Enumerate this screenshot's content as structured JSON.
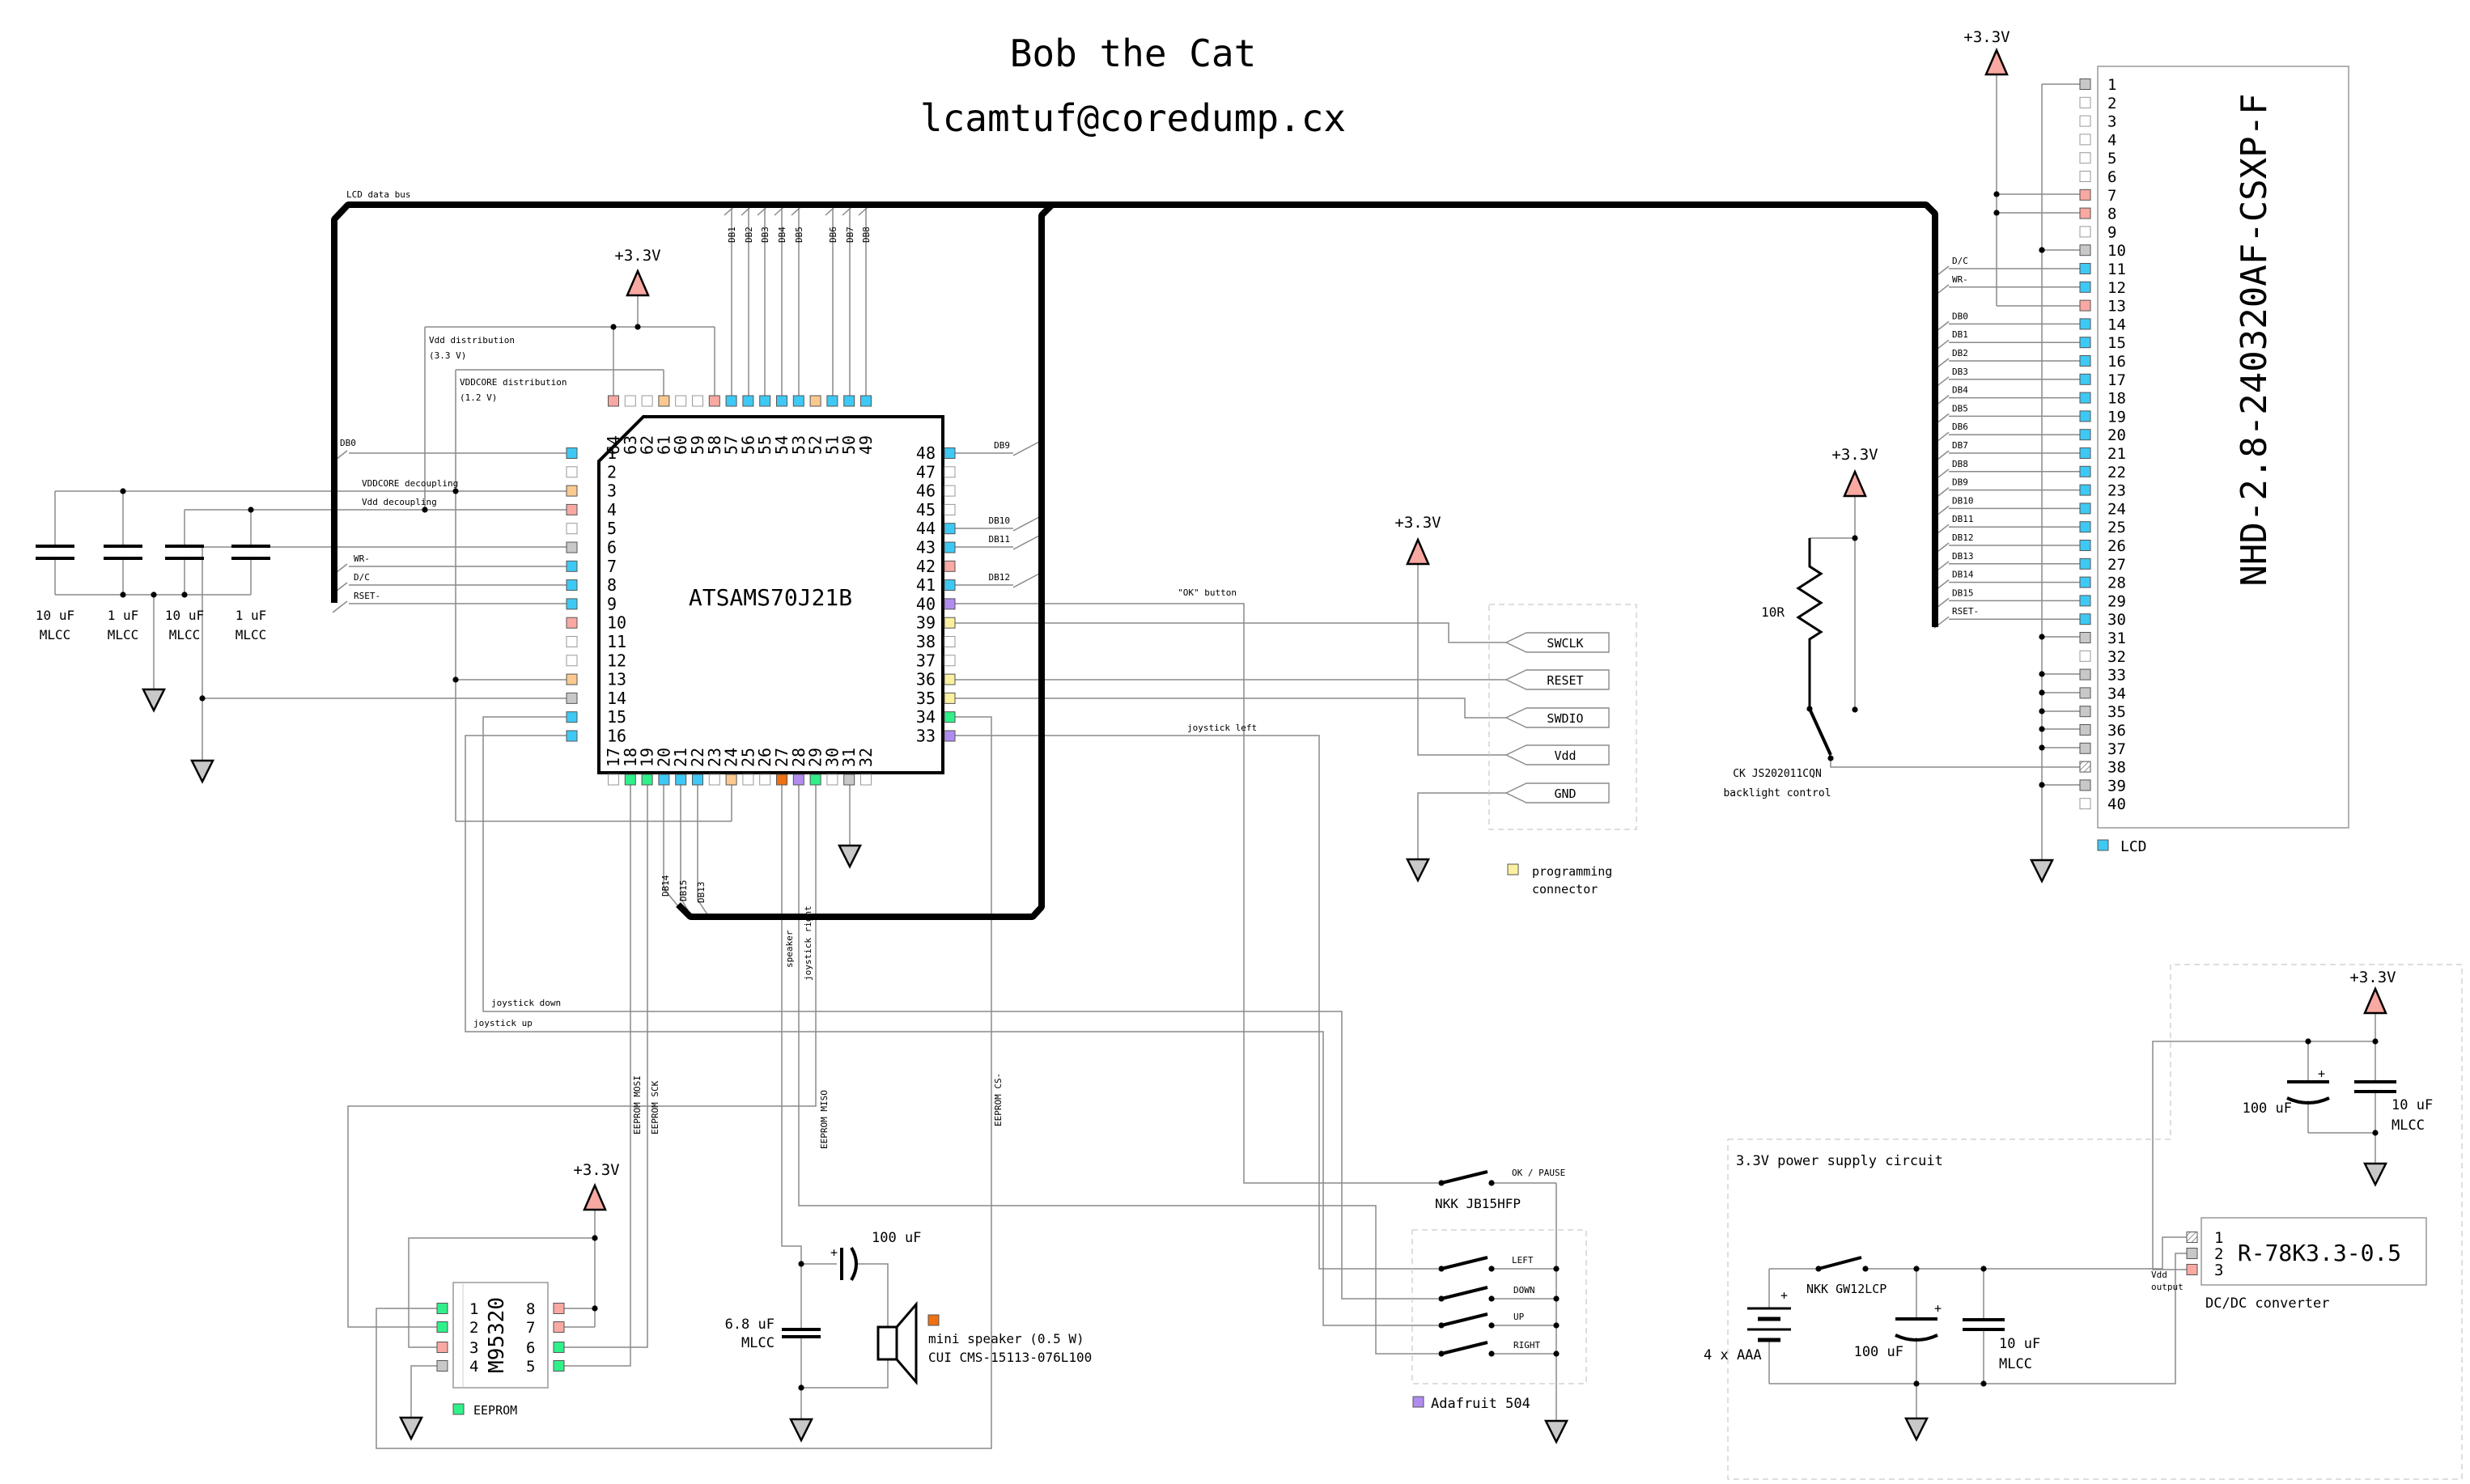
{
  "title": {
    "line1": "Bob the Cat",
    "line2": "lcamtuf@coredump.cx"
  },
  "colors": {
    "blue": "#3ec9f5",
    "pink": "#f9a8a2",
    "orange": "#fbc98f",
    "green": "#30f08a",
    "purple": "#b18cf0",
    "yellow": "#faf0a0",
    "gray": "#c8c8c8",
    "white": "#ffffff",
    "dark_orange": "#ef7012",
    "bus": "#000000",
    "wire": "#8a8a8a"
  },
  "bus_label": "LCD data bus",
  "rails": {
    "v33": "+3.3V"
  },
  "mcu": {
    "name": "ATSAMS70J21B",
    "left_pins": [
      {
        "n": 1,
        "c": "blue"
      },
      {
        "n": 2,
        "c": "white"
      },
      {
        "n": 3,
        "c": "orange"
      },
      {
        "n": 4,
        "c": "pink"
      },
      {
        "n": 5,
        "c": "white"
      },
      {
        "n": 6,
        "c": "gray"
      },
      {
        "n": 7,
        "c": "blue"
      },
      {
        "n": 8,
        "c": "blue"
      },
      {
        "n": 9,
        "c": "blue"
      },
      {
        "n": 10,
        "c": "pink"
      },
      {
        "n": 11,
        "c": "white"
      },
      {
        "n": 12,
        "c": "white"
      },
      {
        "n": 13,
        "c": "orange"
      },
      {
        "n": 14,
        "c": "gray"
      },
      {
        "n": 15,
        "c": "blue"
      },
      {
        "n": 16,
        "c": "blue"
      }
    ],
    "top_pins": [
      {
        "n": 64,
        "c": "pink"
      },
      {
        "n": 63,
        "c": "white"
      },
      {
        "n": 62,
        "c": "white"
      },
      {
        "n": 61,
        "c": "orange"
      },
      {
        "n": 60,
        "c": "white"
      },
      {
        "n": 59,
        "c": "white"
      },
      {
        "n": 58,
        "c": "pink"
      },
      {
        "n": 57,
        "c": "blue"
      },
      {
        "n": 56,
        "c": "blue"
      },
      {
        "n": 55,
        "c": "blue"
      },
      {
        "n": 54,
        "c": "blue"
      },
      {
        "n": 53,
        "c": "blue"
      },
      {
        "n": 52,
        "c": "orange"
      },
      {
        "n": 51,
        "c": "blue"
      },
      {
        "n": 50,
        "c": "blue"
      },
      {
        "n": 49,
        "c": "blue"
      }
    ],
    "right_pins": [
      {
        "n": 48,
        "c": "blue"
      },
      {
        "n": 47,
        "c": "white"
      },
      {
        "n": 46,
        "c": "white"
      },
      {
        "n": 45,
        "c": "white"
      },
      {
        "n": 44,
        "c": "blue"
      },
      {
        "n": 43,
        "c": "blue"
      },
      {
        "n": 42,
        "c": "pink"
      },
      {
        "n": 41,
        "c": "blue"
      },
      {
        "n": 40,
        "c": "purple"
      },
      {
        "n": 39,
        "c": "yellow"
      },
      {
        "n": 38,
        "c": "white"
      },
      {
        "n": 37,
        "c": "white"
      },
      {
        "n": 36,
        "c": "yellow"
      },
      {
        "n": 35,
        "c": "yellow"
      },
      {
        "n": 34,
        "c": "green"
      },
      {
        "n": 33,
        "c": "purple"
      }
    ],
    "bottom_pins": [
      {
        "n": 17,
        "c": "white"
      },
      {
        "n": 18,
        "c": "green"
      },
      {
        "n": 19,
        "c": "green"
      },
      {
        "n": 20,
        "c": "blue"
      },
      {
        "n": 21,
        "c": "blue"
      },
      {
        "n": 22,
        "c": "blue"
      },
      {
        "n": 23,
        "c": "white"
      },
      {
        "n": 24,
        "c": "orange"
      },
      {
        "n": 25,
        "c": "white"
      },
      {
        "n": 26,
        "c": "white"
      },
      {
        "n": 27,
        "c": "dark_orange"
      },
      {
        "n": 28,
        "c": "purple"
      },
      {
        "n": 29,
        "c": "green"
      },
      {
        "n": 30,
        "c": "white"
      },
      {
        "n": 31,
        "c": "gray"
      },
      {
        "n": 32,
        "c": "white"
      }
    ]
  },
  "lcd": {
    "name": "NHD-2.8-240320AF-CSXP-F",
    "legend": "LCD",
    "pins": [
      {
        "n": 1,
        "c": "gray"
      },
      {
        "n": 2,
        "c": "white"
      },
      {
        "n": 3,
        "c": "white"
      },
      {
        "n": 4,
        "c": "white"
      },
      {
        "n": 5,
        "c": "white"
      },
      {
        "n": 6,
        "c": "white"
      },
      {
        "n": 7,
        "c": "pink"
      },
      {
        "n": 8,
        "c": "pink"
      },
      {
        "n": 9,
        "c": "white"
      },
      {
        "n": 10,
        "c": "gray"
      },
      {
        "n": 11,
        "c": "blue"
      },
      {
        "n": 12,
        "c": "blue"
      },
      {
        "n": 13,
        "c": "pink"
      },
      {
        "n": 14,
        "c": "blue"
      },
      {
        "n": 15,
        "c": "blue"
      },
      {
        "n": 16,
        "c": "blue"
      },
      {
        "n": 17,
        "c": "blue"
      },
      {
        "n": 18,
        "c": "blue"
      },
      {
        "n": 19,
        "c": "blue"
      },
      {
        "n": 20,
        "c": "blue"
      },
      {
        "n": 21,
        "c": "blue"
      },
      {
        "n": 22,
        "c": "blue"
      },
      {
        "n": 23,
        "c": "blue"
      },
      {
        "n": 24,
        "c": "blue"
      },
      {
        "n": 25,
        "c": "blue"
      },
      {
        "n": 26,
        "c": "blue"
      },
      {
        "n": 27,
        "c": "blue"
      },
      {
        "n": 28,
        "c": "blue"
      },
      {
        "n": 29,
        "c": "blue"
      },
      {
        "n": 30,
        "c": "blue"
      },
      {
        "n": 31,
        "c": "gray"
      },
      {
        "n": 32,
        "c": "white"
      },
      {
        "n": 33,
        "c": "gray"
      },
      {
        "n": 34,
        "c": "gray"
      },
      {
        "n": 35,
        "c": "gray"
      },
      {
        "n": 36,
        "c": "gray"
      },
      {
        "n": 37,
        "c": "gray"
      },
      {
        "n": 38,
        "c": "hatched"
      },
      {
        "n": 39,
        "c": "gray"
      },
      {
        "n": 40,
        "c": "white"
      }
    ],
    "signal_labels": [
      "D/C",
      "WR-",
      "DB0",
      "DB1",
      "DB2",
      "DB3",
      "DB4",
      "DB5",
      "DB6",
      "DB7",
      "DB8",
      "DB9",
      "DB10",
      "DB11",
      "DB12",
      "DB13",
      "DB14",
      "DB15",
      "RSET-"
    ]
  },
  "eeprom": {
    "name": "M95320",
    "legend": "EEPROM",
    "left_pins": [
      {
        "n": 1,
        "c": "green"
      },
      {
        "n": 2,
        "c": "green"
      },
      {
        "n": 3,
        "c": "pink"
      },
      {
        "n": 4,
        "c": "gray"
      }
    ],
    "right_pins": [
      {
        "n": 8,
        "c": "pink"
      },
      {
        "n": 7,
        "c": "pink"
      },
      {
        "n": 6,
        "c": "green"
      },
      {
        "n": 5,
        "c": "green"
      }
    ]
  },
  "dcdc": {
    "name": "R-78K3.3-0.5",
    "label": "DC/DC converter",
    "pins": [
      {
        "n": 1,
        "c": "hatched"
      },
      {
        "n": 2,
        "c": "gray"
      },
      {
        "n": 3,
        "c": "pink"
      }
    ],
    "vdd_output": [
      "Vdd",
      "output"
    ]
  },
  "programming": {
    "flags": [
      "SWCLK",
      "RESET",
      "SWDIO",
      "Vdd",
      "GND"
    ],
    "legend": [
      "programming",
      "connector"
    ]
  },
  "backlight": {
    "resistor": "10R",
    "part": "CK JS202011CQN",
    "label": "backlight control"
  },
  "joystick": {
    "ok_switch": "OK / PAUSE",
    "part": "NKK JB15HFP",
    "switches": [
      "LEFT",
      "DOWN",
      "UP",
      "RIGHT"
    ],
    "legend": "Adafruit 504"
  },
  "speaker": {
    "cap1": "100 uF",
    "plus": "+",
    "cap2": [
      "6.8 uF",
      "MLCC"
    ],
    "legend": [
      "mini speaker (0.5 W)",
      "CUI CMS-15113-076L100"
    ]
  },
  "power": {
    "section": "3.3V power supply circuit",
    "battery": "4 x AAA",
    "plus": "+",
    "switch": "NKK GW12LCP",
    "cap1": "100 uF",
    "cap2": [
      "10 uF",
      "MLCC"
    ],
    "out_cap1": "100 uF",
    "out_cap2": [
      "10 uF",
      "MLCC"
    ]
  },
  "decoupling": {
    "cap_labels": [
      [
        "10 uF",
        "MLCC"
      ],
      [
        "1 uF",
        "MLCC"
      ],
      [
        "10 uF",
        "MLCC"
      ],
      [
        "1 uF",
        "MLCC"
      ]
    ],
    "vddcore": "VDDCORE decoupling",
    "vdd": "Vdd decoupling"
  },
  "distribution": {
    "vdd": [
      "Vdd distribution",
      "(3.3 V)"
    ],
    "vddcore": [
      "VDDCORE distribution",
      "(1.2 V)"
    ]
  },
  "wire_labels": {
    "left": [
      "DB0",
      "WR-",
      "D/C",
      "RSET-"
    ],
    "db_top": [
      "DB1",
      "DB2",
      "DB3",
      "DB4",
      "DB5",
      "DB6",
      "DB7",
      "DB8"
    ],
    "db_right": [
      "DB9",
      "DB10",
      "DB11",
      "DB12"
    ],
    "db_bottom": [
      "DB14",
      "DB15",
      "DB13"
    ],
    "ok": "\"OK\" button",
    "jleft": "joystick left",
    "jdown": "joystick down",
    "jup": "joystick up",
    "jright": "joystick right",
    "spk": "speaker",
    "mosi": "EEPROM MOSI",
    "sck": "EEPROM SCK",
    "miso": "EEPROM MISO",
    "cs": "EEPROM CS-"
  }
}
